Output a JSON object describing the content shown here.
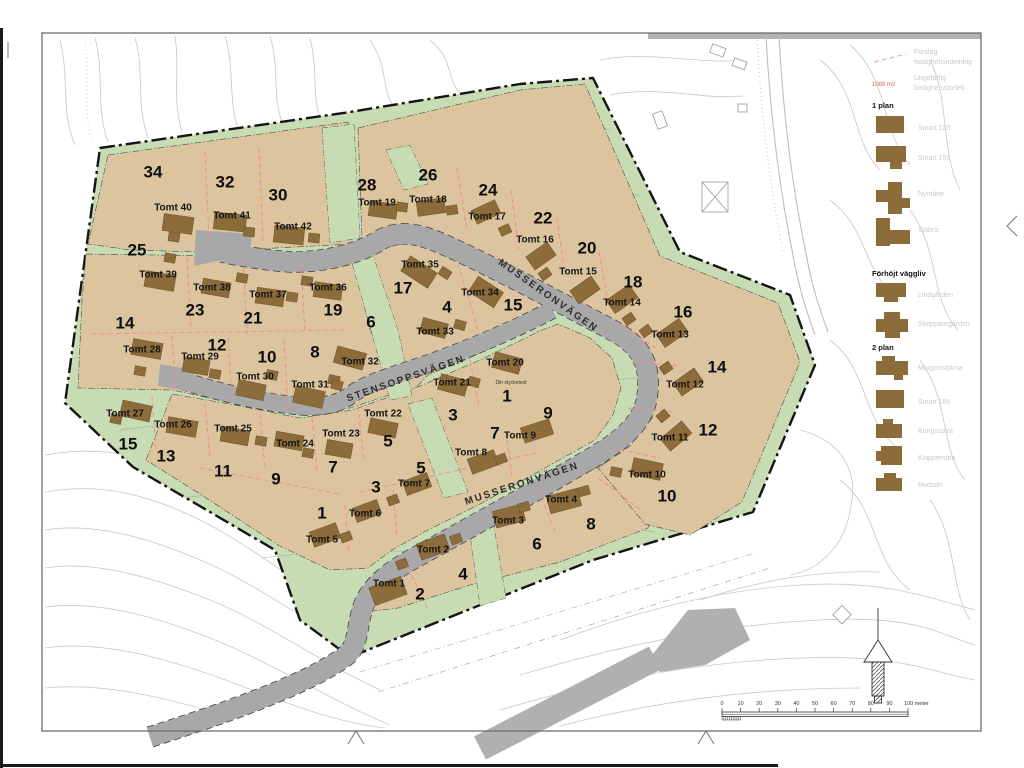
{
  "map": {
    "streets": [
      {
        "name": "MUSSERONVÄGEN",
        "x": 548,
        "y": 296,
        "rot": 35
      },
      {
        "name": "STENSOPPSVÄGEN",
        "x": 406,
        "y": 379,
        "rot": -19
      },
      {
        "name": "MUSSERONVÄGEN",
        "x": 522,
        "y": 484,
        "rot": -18
      }
    ],
    "note": {
      "text": "Din stycketext",
      "x": 511,
      "y": 384
    },
    "lots": [
      {
        "t": "Tomt 1",
        "tx": 389,
        "ty": 584,
        "n": "2",
        "nx": 420,
        "ny": 594,
        "h": [
          388,
          591,
          34,
          19,
          -20
        ],
        "g": [
          402,
          564
        ]
      },
      {
        "t": "Tomt 2",
        "tx": 433,
        "ty": 550,
        "n": "4",
        "nx": 463,
        "ny": 574,
        "h": [
          433,
          547,
          30,
          17,
          -20
        ],
        "g": [
          456,
          539
        ]
      },
      {
        "t": "Tomt 3",
        "tx": 508,
        "ty": 521,
        "n": "6",
        "nx": 537,
        "ny": 544,
        "h": [
          509,
          516,
          30,
          17,
          -15
        ],
        "g": [
          524,
          507
        ]
      },
      {
        "t": "Tomt 4",
        "tx": 561,
        "ty": 500,
        "n": "8",
        "nx": 591,
        "ny": 524,
        "h": [
          564,
          501,
          32,
          18,
          -15
        ],
        "g": [
          584,
          491
        ]
      },
      {
        "t": "Tomt 5",
        "tx": 322,
        "ty": 540,
        "n": "1",
        "nx": 322,
        "ny": 513,
        "h": [
          325,
          535,
          28,
          16,
          -20
        ],
        "g": [
          346,
          537
        ]
      },
      {
        "t": "Tomt 6",
        "tx": 365,
        "ty": 514,
        "n": "3",
        "nx": 376,
        "ny": 487,
        "h": [
          367,
          511,
          26,
          15,
          -20
        ],
        "g": [
          393,
          500
        ]
      },
      {
        "t": "Tomt 7",
        "tx": 414,
        "ty": 484,
        "n": "5",
        "nx": 421,
        "ny": 468,
        "h": [
          417,
          484,
          26,
          15,
          -20
        ]
      },
      {
        "t": "Tomt 8",
        "tx": 471,
        "ty": 453,
        "n": "7",
        "nx": 495,
        "ny": 433,
        "h": [
          483,
          462,
          28,
          16,
          -20
        ],
        "g": [
          501,
          459
        ]
      },
      {
        "t": "Tomt 9",
        "tx": 520,
        "ty": 436,
        "n": "9",
        "nx": 548,
        "ny": 413,
        "h": [
          537,
          431,
          30,
          16,
          -18
        ]
      },
      {
        "t": "Tomt 10",
        "tx": 647,
        "ty": 475,
        "n": "10",
        "nx": 667,
        "ny": 496,
        "h": [
          647,
          469,
          30,
          17,
          12
        ],
        "g": [
          616,
          472
        ]
      },
      {
        "t": "Tomt 11",
        "tx": 670,
        "ty": 438,
        "n": "12",
        "nx": 708,
        "ny": 430,
        "h": [
          676,
          436,
          28,
          16,
          -40
        ],
        "g": [
          663,
          416
        ]
      },
      {
        "t": "Tomt 12",
        "tx": 685,
        "ty": 385,
        "n": "14",
        "nx": 717,
        "ny": 367,
        "h": [
          688,
          382,
          26,
          16,
          -35
        ],
        "g": [
          666,
          368
        ]
      },
      {
        "t": "Tomt 13",
        "tx": 670,
        "ty": 335,
        "n": "16",
        "nx": 683,
        "ny": 312,
        "h": [
          672,
          333,
          28,
          16,
          -35
        ],
        "g": [
          646,
          331
        ]
      },
      {
        "t": "Tomt 14",
        "tx": 622,
        "ty": 303,
        "n": "18",
        "nx": 633,
        "ny": 282,
        "h": [
          622,
          299,
          28,
          16,
          -35
        ],
        "g": [
          629,
          319
        ]
      },
      {
        "t": "Tomt 15",
        "tx": 578,
        "ty": 272,
        "n": "20",
        "nx": 587,
        "ny": 248,
        "h": [
          585,
          290,
          26,
          16,
          -35
        ]
      },
      {
        "t": "Tomt 16",
        "tx": 535,
        "ty": 240,
        "n": "22",
        "nx": 543,
        "ny": 218,
        "h": [
          541,
          256,
          26,
          16,
          -35
        ],
        "g": [
          545,
          274
        ]
      },
      {
        "t": "Tomt 17",
        "tx": 487,
        "ty": 217,
        "n": "24",
        "nx": 488,
        "ny": 190,
        "h": [
          486,
          212,
          26,
          15,
          -25
        ],
        "g": [
          505,
          230
        ]
      },
      {
        "t": "Tomt 18",
        "tx": 428,
        "ty": 200,
        "n": "26",
        "nx": 428,
        "ny": 175,
        "h": [
          431,
          207,
          28,
          15,
          -8
        ],
        "g": [
          452,
          210
        ]
      },
      {
        "t": "Tomt 19",
        "tx": 377,
        "ty": 203,
        "n": "28",
        "nx": 367,
        "ny": 185,
        "h": [
          383,
          210,
          28,
          15,
          8
        ],
        "g": [
          402,
          207
        ]
      },
      {
        "t": "Tomt 20",
        "tx": 505,
        "ty": 363,
        "n": "1",
        "nx": 507,
        "ny": 396,
        "h": [
          507,
          363,
          28,
          16,
          15
        ]
      },
      {
        "t": "Tomt 21",
        "tx": 452,
        "ty": 383,
        "n": "3",
        "nx": 453,
        "ny": 415,
        "h": [
          453,
          385,
          28,
          16,
          15
        ],
        "g": [
          474,
          382
        ]
      },
      {
        "t": "Tomt 22",
        "tx": 383,
        "ty": 414,
        "n": "5",
        "nx": 388,
        "ny": 441,
        "h": [
          383,
          428,
          28,
          15,
          12
        ]
      },
      {
        "t": "Tomt 23",
        "tx": 341,
        "ty": 434,
        "n": "7",
        "nx": 333,
        "ny": 467,
        "h": [
          339,
          449,
          26,
          15,
          10
        ]
      },
      {
        "t": "Tomt 24",
        "tx": 295,
        "ty": 444,
        "n": "9",
        "nx": 276,
        "ny": 479,
        "h": [
          289,
          441,
          28,
          15,
          10
        ],
        "g": [
          308,
          453
        ]
      },
      {
        "t": "Tomt 25",
        "tx": 233,
        "ty": 429,
        "n": "11",
        "nx": 223,
        "ny": 471,
        "h": [
          235,
          436,
          28,
          15,
          10
        ],
        "g": [
          261,
          441
        ]
      },
      {
        "t": "Tomt 26",
        "tx": 173,
        "ty": 425,
        "n": "13",
        "nx": 166,
        "ny": 456,
        "h": [
          182,
          427,
          30,
          16,
          10
        ]
      },
      {
        "t": "Tomt 27",
        "tx": 125,
        "ty": 414,
        "n": "15",
        "nx": 128,
        "ny": 444,
        "h": [
          136,
          411,
          30,
          16,
          12
        ],
        "g": [
          116,
          419
        ]
      },
      {
        "t": "Tomt 28",
        "tx": 142,
        "ty": 350,
        "n": "14",
        "nx": 125,
        "ny": 323,
        "h": [
          147,
          349,
          30,
          16,
          10
        ],
        "g": [
          140,
          371
        ]
      },
      {
        "t": "Tomt 29",
        "tx": 200,
        "ty": 357,
        "n": "12",
        "nx": 217,
        "ny": 345,
        "h": [
          196,
          366,
          26,
          15,
          10
        ],
        "g": [
          215,
          374
        ]
      },
      {
        "t": "Tomt 30",
        "tx": 255,
        "ty": 377,
        "n": "10",
        "nx": 267,
        "ny": 357,
        "h": [
          251,
          390,
          28,
          16,
          12
        ],
        "g": [
          272,
          375
        ]
      },
      {
        "t": "Tomt 31",
        "tx": 310,
        "ty": 385,
        "n": "8",
        "nx": 315,
        "ny": 352,
        "h": [
          309,
          397,
          30,
          17,
          12
        ],
        "g": [
          334,
          380
        ]
      },
      {
        "t": "Tomt 32",
        "tx": 360,
        "ty": 362,
        "n": "6",
        "nx": 371,
        "ny": 322,
        "h": [
          350,
          358,
          30,
          17,
          15
        ],
        "g": [
          337,
          385
        ]
      },
      {
        "t": "Tomt 33",
        "tx": 435,
        "ty": 332,
        "n": "4",
        "nx": 447,
        "ny": 307,
        "h": [
          434,
          328,
          26,
          15,
          15
        ],
        "g": [
          460,
          325
        ]
      },
      {
        "t": "Tomt 34",
        "tx": 480,
        "ty": 293,
        "n": "15",
        "nx": 513,
        "ny": 305,
        "h": [
          486,
          292,
          30,
          18,
          33
        ]
      },
      {
        "t": "Tomt 35",
        "tx": 420,
        "ty": 265,
        "n": "17",
        "nx": 403,
        "ny": 288,
        "h": [
          419,
          272,
          32,
          18,
          33
        ],
        "g": [
          445,
          273
        ]
      },
      {
        "t": "Tomt 36",
        "tx": 328,
        "ty": 288,
        "n": "19",
        "nx": 333,
        "ny": 310,
        "h": [
          328,
          291,
          28,
          15,
          8
        ],
        "g": [
          307,
          281
        ]
      },
      {
        "t": "Tomt 37",
        "tx": 268,
        "ty": 295,
        "n": "21",
        "nx": 253,
        "ny": 318,
        "h": [
          270,
          297,
          28,
          16,
          8
        ],
        "g": [
          292,
          297
        ]
      },
      {
        "t": "Tomt 38",
        "tx": 212,
        "ty": 288,
        "n": "23",
        "nx": 195,
        "ny": 310,
        "h": [
          216,
          288,
          28,
          15,
          10
        ],
        "g": [
          242,
          278
        ]
      },
      {
        "t": "Tomt 39",
        "tx": 158,
        "ty": 275,
        "n": "25",
        "nx": 137,
        "ny": 250,
        "h": [
          160,
          281,
          30,
          16,
          10
        ],
        "g": [
          170,
          258
        ]
      },
      {
        "t": "Tomt 40",
        "tx": 173,
        "ty": 208,
        "n": "34",
        "nx": 153,
        "ny": 172,
        "h": [
          178,
          224,
          30,
          17,
          8
        ],
        "g": [
          174,
          237
        ]
      },
      {
        "t": "Tomt 41",
        "tx": 232,
        "ty": 216,
        "n": "32",
        "nx": 225,
        "ny": 182,
        "h": [
          230,
          222,
          32,
          17,
          6
        ],
        "g": [
          249,
          232
        ]
      },
      {
        "t": "Tomt 42",
        "tx": 293,
        "ty": 227,
        "n": "30",
        "nx": 278,
        "ny": 195,
        "h": [
          289,
          235,
          30,
          17,
          6
        ],
        "g": [
          314,
          238
        ]
      }
    ]
  },
  "legend": {
    "entries": [
      {
        "type": "line",
        "label1": "Förslag",
        "label2": "fastighetsindelning",
        "y": 50
      },
      {
        "type": "size",
        "symbol": "1088 m2",
        "label1": "Ungefärlig",
        "label2": "fastighetsstorlek",
        "y": 76
      },
      {
        "type": "header",
        "label": "1 plan",
        "y": 108
      },
      {
        "type": "house",
        "label": "Smart 125",
        "y": 116,
        "icon": [
          [
            0,
            0,
            28,
            17
          ]
        ]
      },
      {
        "type": "house",
        "label": "Smart 150",
        "y": 146,
        "icon": [
          [
            0,
            0,
            30,
            16
          ],
          [
            14,
            16,
            12,
            7
          ]
        ]
      },
      {
        "type": "house",
        "label": "Nymåne",
        "y": 182,
        "icon": [
          [
            0,
            8,
            18,
            12
          ],
          [
            12,
            0,
            14,
            32
          ],
          [
            26,
            16,
            8,
            10
          ]
        ]
      },
      {
        "type": "house",
        "label": "Sjöbris",
        "y": 218,
        "icon": [
          [
            0,
            0,
            14,
            28
          ],
          [
            12,
            12,
            22,
            14
          ]
        ]
      },
      {
        "type": "header",
        "label": "Förhöjt väggliv",
        "y": 276
      },
      {
        "type": "house",
        "label": "Lindgården",
        "y": 283,
        "icon": [
          [
            0,
            0,
            30,
            14
          ],
          [
            8,
            14,
            14,
            5
          ]
        ]
      },
      {
        "type": "house",
        "label": "Skepparegården",
        "y": 312,
        "icon": [
          [
            8,
            0,
            16,
            7
          ],
          [
            0,
            7,
            32,
            13
          ],
          [
            9,
            20,
            15,
            6
          ]
        ]
      },
      {
        "type": "header",
        "label": "2 plan",
        "y": 350
      },
      {
        "type": "house",
        "label": "Morgonstjärna",
        "y": 356,
        "icon": [
          [
            0,
            5,
            32,
            14
          ],
          [
            6,
            0,
            13,
            5
          ],
          [
            18,
            19,
            9,
            5
          ]
        ]
      },
      {
        "type": "house",
        "label": "Smart 166",
        "y": 390,
        "icon": [
          [
            0,
            0,
            28,
            18
          ]
        ]
      },
      {
        "type": "house",
        "label": "Kungsspira",
        "y": 419,
        "icon": [
          [
            0,
            5,
            26,
            14
          ],
          [
            7,
            0,
            10,
            5
          ]
        ]
      },
      {
        "type": "house",
        "label": "Klappersten",
        "y": 446,
        "icon": [
          [
            5,
            0,
            21,
            19
          ],
          [
            0,
            5,
            5,
            10
          ]
        ]
      },
      {
        "type": "house",
        "label": "Hudson",
        "y": 473,
        "icon": [
          [
            0,
            5,
            26,
            13
          ],
          [
            8,
            0,
            12,
            5
          ]
        ]
      }
    ]
  },
  "scalebar": {
    "x": 722,
    "y": 712,
    "length": 186,
    "ticks": [
      "0",
      "10",
      "20",
      "30",
      "40",
      "50",
      "60",
      "70",
      "80",
      "90"
    ],
    "end_label": "100 meter"
  },
  "colors": {
    "green": "#c8dcb3",
    "tan": "#dcc49e",
    "house": "#8c6c3a",
    "house_stroke": "#6a5129",
    "road": "#a8a8ab",
    "red_dash": "#ef8f8f",
    "pink": "#f2a5b8",
    "legend_gray": "#c9c9c9"
  }
}
